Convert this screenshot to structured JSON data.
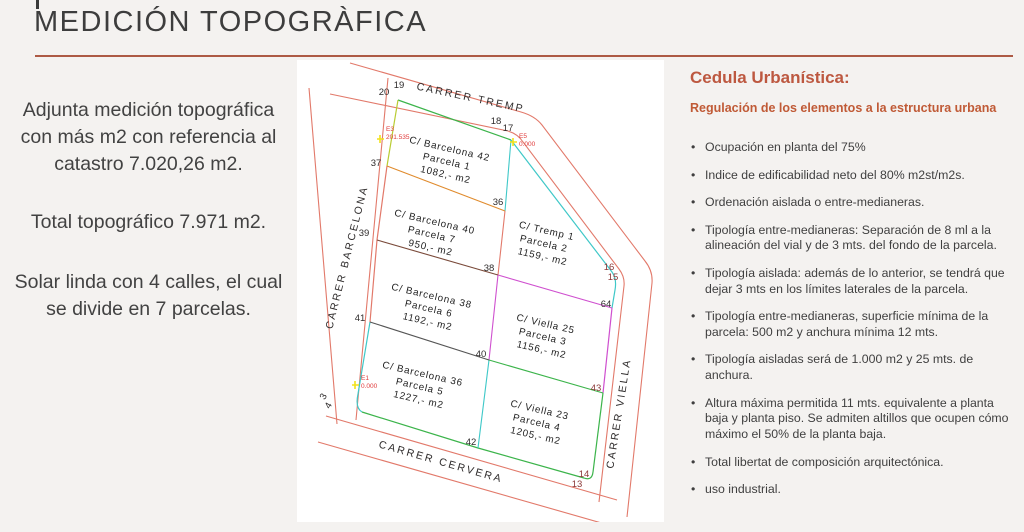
{
  "title": "MEDICIÓN TOPOGRÀFICA",
  "left_panel": {
    "p1": "Adjunta medición topográfica con más m2 con referencia al catastro 7.020,26 m2.",
    "p2": "Total topográfico 7.971 m2.",
    "p3": "Solar linda con  4 calles, el cual se divide en 7 parcelas."
  },
  "map": {
    "streets": {
      "top": "CARRER  TREMP",
      "left": "CARRER  BARCELONA",
      "bottom": "CARRER  CERVERA",
      "right": "CARRER  VIELLA"
    },
    "parcels": [
      {
        "street": "C/ Barcelona 42",
        "parcel": "Parcela  1",
        "area": "1082,-  m2"
      },
      {
        "street": "C/ Barcelona 40",
        "parcel": "Parcela  7",
        "area": "950,-  m2"
      },
      {
        "street": "C/ Tremp  1",
        "parcel": "Parcela  2",
        "area": "1159,-  m2"
      },
      {
        "street": "C/ Barcelona 38",
        "parcel": "Parcela  6",
        "area": "1192,-  m2"
      },
      {
        "street": "C/ Viella 25",
        "parcel": "Parcela  3",
        "area": "1156,-  m2"
      },
      {
        "street": "C/ Barcelona 36",
        "parcel": "Parcela  5",
        "area": "1227,-  m2"
      },
      {
        "street": "C/ Viella  23",
        "parcel": "Parcela 4",
        "area": "1205,-  m2"
      }
    ],
    "vertices": [
      "20",
      "19",
      "18",
      "17",
      "37",
      "36",
      "39",
      "38",
      "41",
      "40",
      "42",
      "64",
      "43",
      "16",
      "15",
      "14",
      "13",
      "3",
      "4"
    ],
    "stations": [
      {
        "id": "E3",
        "value": "201.535"
      },
      {
        "id": "E5",
        "value": "0.000"
      },
      {
        "id": "E1",
        "value": "0.000"
      }
    ]
  },
  "right_panel": {
    "heading": "Cedula Urbanística:",
    "subheading": "Regulación de los elementos a la estructura urbana",
    "bullets": [
      "Ocupación en planta del 75%",
      "Indice de edificabilidad neto del 80% m2st/m2s.",
      "Ordenación aislada o entre-medianeras.",
      "Tipología entre-medianeras: Separación de 8 ml a la alineación del vial y de 3 mts. del fondo de la parcela.",
      "Tipología aislada: además de lo anterior, se tendrá que dejar 3 mts en los límites laterales de la parcela.",
      "Tipología entre-medianeras, superficie mínima de la parcela: 500 m2 y anchura mínima 12 mts.",
      "Tipología aisladas será de 1.000 m2 y 25 mts. de anchura.",
      "Altura máxima permitida 11 mts. equivalente a planta baja y planta piso. Se admiten altillos que ocupen cómo máximo el 50% de la planta baja.",
      "Total libertat de composición arquitectónica.",
      "uso industrial."
    ]
  },
  "colors": {
    "accent_rule": "#ad5a45",
    "heading_orange": "#bd5840",
    "street_red": "#e2796a",
    "boundary_green": "#3cb44b",
    "boundary_cyan": "#3fc8c8",
    "boundary_magenta": "#cf4fcf",
    "boundary_orange": "#e08b2d",
    "station_yellow": "#f2e21c"
  }
}
